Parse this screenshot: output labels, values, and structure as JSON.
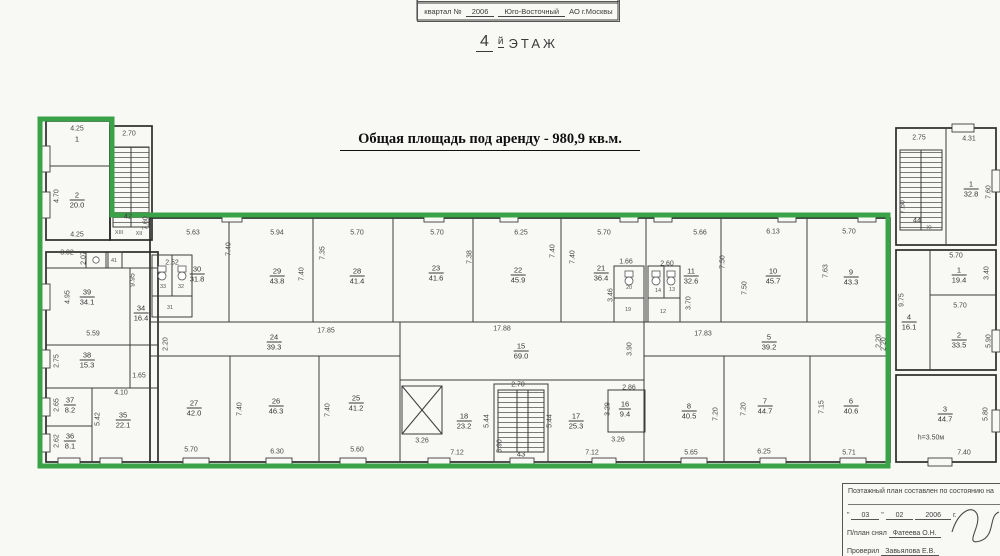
{
  "colors": {
    "outline_green": "#3aa348",
    "ink": "#3a3a3a",
    "paper": "#f8f8f5"
  },
  "header": {
    "box_label": "квартал №",
    "box_value": "2006",
    "box_region": "Юго-Восточный",
    "box_region2": "АО г.Москвы",
    "floor_number": "4",
    "floor_suffix": "й",
    "floor_word": "ЭТАЖ",
    "title": "Общая площадь под аренду - 980,9 кв.м."
  },
  "form": {
    "line1": "Поэтажный план составлен по состоянию на",
    "q1": "\"",
    "date_day": "03",
    "date_month": "02",
    "date_year": "2006",
    "year_suffix": "г.",
    "surveyor_label": "П/план снял",
    "surveyor_name": "Фатеева О.Н.",
    "checker_label": "Проверил",
    "checker_name": "Завьялова Е.В."
  },
  "plan": {
    "rooms": [
      {
        "num": "1",
        "area": "",
        "x": 77,
        "y": 139
      },
      {
        "num": "2",
        "area": "20.0",
        "x": 77,
        "y": 200
      },
      {
        "num": "39",
        "area": "34.1",
        "x": 87,
        "y": 297
      },
      {
        "num": "34",
        "area": "16.4",
        "x": 141,
        "y": 313
      },
      {
        "num": "38",
        "area": "15.3",
        "x": 87,
        "y": 360
      },
      {
        "num": "37",
        "area": "8.2",
        "x": 70,
        "y": 405
      },
      {
        "num": "36",
        "area": "8.1",
        "x": 70,
        "y": 441
      },
      {
        "num": "35",
        "area": "22.1",
        "x": 123,
        "y": 420
      },
      {
        "num": "30",
        "area": "31.8",
        "x": 197,
        "y": 274
      },
      {
        "num": "29",
        "area": "43.8",
        "x": 277,
        "y": 276
      },
      {
        "num": "28",
        "area": "41.4",
        "x": 357,
        "y": 276
      },
      {
        "num": "23",
        "area": "41.6",
        "x": 436,
        "y": 273
      },
      {
        "num": "22",
        "area": "45.9",
        "x": 518,
        "y": 275
      },
      {
        "num": "21",
        "area": "36.4",
        "x": 601,
        "y": 273
      },
      {
        "num": "11",
        "area": "32.6",
        "x": 691,
        "y": 276
      },
      {
        "num": "10",
        "area": "45.7",
        "x": 773,
        "y": 276
      },
      {
        "num": "9",
        "area": "43.3",
        "x": 851,
        "y": 277
      },
      {
        "num": "24",
        "area": "39.3",
        "x": 274,
        "y": 342
      },
      {
        "num": "15",
        "area": "69.0",
        "x": 521,
        "y": 351
      },
      {
        "num": "5",
        "area": "39.2",
        "x": 769,
        "y": 342
      },
      {
        "num": "27",
        "area": "42.0",
        "x": 194,
        "y": 408
      },
      {
        "num": "26",
        "area": "46.3",
        "x": 276,
        "y": 406
      },
      {
        "num": "25",
        "area": "41.2",
        "x": 356,
        "y": 403
      },
      {
        "num": "18",
        "area": "23.2",
        "x": 464,
        "y": 421
      },
      {
        "num": "17",
        "area": "25.3",
        "x": 576,
        "y": 421
      },
      {
        "num": "16",
        "area": "9.4",
        "x": 625,
        "y": 409
      },
      {
        "num": "8",
        "area": "40.5",
        "x": 689,
        "y": 411
      },
      {
        "num": "7",
        "area": "44.7",
        "x": 765,
        "y": 406
      },
      {
        "num": "6",
        "area": "40.6",
        "x": 851,
        "y": 406
      },
      {
        "num": "1",
        "area": "32.8",
        "x": 971,
        "y": 189
      },
      {
        "num": "1",
        "area": "19.4",
        "x": 959,
        "y": 275
      },
      {
        "num": "4",
        "area": "16.1",
        "x": 909,
        "y": 322
      },
      {
        "num": "2",
        "area": "33.5",
        "x": 959,
        "y": 340
      },
      {
        "num": "3",
        "area": "44.7",
        "x": 945,
        "y": 414
      }
    ],
    "stair_labels": [
      {
        "t": "42",
        "x": 128,
        "y": 216
      },
      {
        "t": "43",
        "x": 521,
        "y": 454
      },
      {
        "t": "44",
        "x": 917,
        "y": 220
      }
    ],
    "dims": [
      {
        "t": "4.25",
        "x": 77,
        "y": 129
      },
      {
        "t": "4.70",
        "x": 57,
        "y": 196,
        "r": 1
      },
      {
        "t": "4.25",
        "x": 77,
        "y": 235
      },
      {
        "t": "2.70",
        "x": 129,
        "y": 134
      },
      {
        "t": "7.60",
        "x": 146,
        "y": 223,
        "r": 1
      },
      {
        "t": "3.02",
        "x": 67,
        "y": 253
      },
      {
        "t": "2.07",
        "x": 84,
        "y": 258,
        "r": 1
      },
      {
        "t": "9.95",
        "x": 133,
        "y": 280,
        "r": 1
      },
      {
        "t": "4.95",
        "x": 68,
        "y": 297,
        "r": 1
      },
      {
        "t": "5.59",
        "x": 93,
        "y": 334
      },
      {
        "t": "2.75",
        "x": 57,
        "y": 361,
        "r": 1
      },
      {
        "t": "1.65",
        "x": 139,
        "y": 376
      },
      {
        "t": "4.10",
        "x": 121,
        "y": 393
      },
      {
        "t": "2.65",
        "x": 57,
        "y": 405,
        "r": 1
      },
      {
        "t": "2.62",
        "x": 57,
        "y": 441,
        "r": 1
      },
      {
        "t": "5.42",
        "x": 98,
        "y": 419,
        "r": 1
      },
      {
        "t": "5.63",
        "x": 193,
        "y": 233
      },
      {
        "t": "5.94",
        "x": 277,
        "y": 233
      },
      {
        "t": "5.70",
        "x": 357,
        "y": 233
      },
      {
        "t": "5.70",
        "x": 437,
        "y": 233
      },
      {
        "t": "6.25",
        "x": 521,
        "y": 233
      },
      {
        "t": "5.70",
        "x": 604,
        "y": 233
      },
      {
        "t": "5.66",
        "x": 700,
        "y": 233
      },
      {
        "t": "6.13",
        "x": 773,
        "y": 232
      },
      {
        "t": "5.70",
        "x": 849,
        "y": 232
      },
      {
        "t": "7.40",
        "x": 229,
        "y": 249,
        "r": 1
      },
      {
        "t": "7.40",
        "x": 302,
        "y": 274,
        "r": 1
      },
      {
        "t": "7.35",
        "x": 323,
        "y": 253,
        "r": 1
      },
      {
        "t": "7.38",
        "x": 470,
        "y": 257,
        "r": 1
      },
      {
        "t": "7.40",
        "x": 553,
        "y": 251,
        "r": 1
      },
      {
        "t": "7.40",
        "x": 573,
        "y": 257,
        "r": 1
      },
      {
        "t": "7.50",
        "x": 723,
        "y": 262,
        "r": 1
      },
      {
        "t": "7.50",
        "x": 745,
        "y": 288,
        "r": 1
      },
      {
        "t": "7.63",
        "x": 826,
        "y": 271,
        "r": 1
      },
      {
        "t": "2.52",
        "x": 172,
        "y": 263
      },
      {
        "t": "1.66",
        "x": 626,
        "y": 262
      },
      {
        "t": "2.60",
        "x": 667,
        "y": 264
      },
      {
        "t": "3.46",
        "x": 611,
        "y": 295,
        "r": 1
      },
      {
        "t": "3.70",
        "x": 689,
        "y": 303,
        "r": 1
      },
      {
        "t": "17.85",
        "x": 326,
        "y": 331
      },
      {
        "t": "2.20",
        "x": 166,
        "y": 344,
        "r": 1
      },
      {
        "t": "17.88",
        "x": 502,
        "y": 329
      },
      {
        "t": "3.90",
        "x": 630,
        "y": 349,
        "r": 1
      },
      {
        "t": "17.83",
        "x": 703,
        "y": 334
      },
      {
        "t": "2.20",
        "x": 884,
        "y": 344,
        "r": 1
      },
      {
        "t": "7.40",
        "x": 240,
        "y": 409,
        "r": 1
      },
      {
        "t": "7.40",
        "x": 328,
        "y": 410,
        "r": 1
      },
      {
        "t": "5.70",
        "x": 191,
        "y": 450
      },
      {
        "t": "6.30",
        "x": 277,
        "y": 452
      },
      {
        "t": "5.60",
        "x": 357,
        "y": 450
      },
      {
        "t": "3.26",
        "x": 422,
        "y": 441
      },
      {
        "t": "5.44",
        "x": 487,
        "y": 421,
        "r": 1
      },
      {
        "t": "2.70",
        "x": 518,
        "y": 385
      },
      {
        "t": "5.90",
        "x": 500,
        "y": 446,
        "r": 1
      },
      {
        "t": "5.44",
        "x": 550,
        "y": 421,
        "r": 1
      },
      {
        "t": "7.12",
        "x": 457,
        "y": 453
      },
      {
        "t": "7.12",
        "x": 592,
        "y": 453
      },
      {
        "t": "3.29",
        "x": 608,
        "y": 409,
        "r": 1
      },
      {
        "t": "2.86",
        "x": 629,
        "y": 388
      },
      {
        "t": "3.26",
        "x": 618,
        "y": 440
      },
      {
        "t": "7.20",
        "x": 716,
        "y": 414,
        "r": 1
      },
      {
        "t": "7.20",
        "x": 744,
        "y": 409,
        "r": 1
      },
      {
        "t": "7.15",
        "x": 822,
        "y": 407,
        "r": 1
      },
      {
        "t": "5.65",
        "x": 691,
        "y": 453
      },
      {
        "t": "6.25",
        "x": 764,
        "y": 452
      },
      {
        "t": "5.71",
        "x": 849,
        "y": 453
      },
      {
        "t": "2.75",
        "x": 919,
        "y": 138
      },
      {
        "t": "4.31",
        "x": 969,
        "y": 139
      },
      {
        "t": "7.60",
        "x": 903,
        "y": 207,
        "r": 1
      },
      {
        "t": "7.60",
        "x": 989,
        "y": 192,
        "r": 1
      },
      {
        "t": "5.70",
        "x": 956,
        "y": 256
      },
      {
        "t": "3.40",
        "x": 987,
        "y": 273,
        "r": 1
      },
      {
        "t": "9.75",
        "x": 902,
        "y": 300,
        "r": 1
      },
      {
        "t": "5.70",
        "x": 960,
        "y": 306
      },
      {
        "t": "2.20",
        "x": 879,
        "y": 341,
        "r": 1
      },
      {
        "t": "5.90",
        "x": 989,
        "y": 341,
        "r": 1
      },
      {
        "t": "5.80",
        "x": 986,
        "y": 414,
        "r": 1
      },
      {
        "t": "7.40",
        "x": 964,
        "y": 453
      },
      {
        "t": "h=3.50м",
        "x": 931,
        "y": 438
      }
    ],
    "tiny_labels": [
      {
        "t": "XIII",
        "x": 119,
        "y": 233
      },
      {
        "t": "XII",
        "x": 139,
        "y": 234
      },
      {
        "t": "XI",
        "x": 929,
        "y": 228
      },
      {
        "t": "41",
        "x": 114,
        "y": 261
      },
      {
        "t": "33",
        "x": 163,
        "y": 287
      },
      {
        "t": "32",
        "x": 181,
        "y": 287
      },
      {
        "t": "31",
        "x": 170,
        "y": 308
      },
      {
        "t": "20",
        "x": 629,
        "y": 288
      },
      {
        "t": "19",
        "x": 628,
        "y": 310
      },
      {
        "t": "14",
        "x": 658,
        "y": 291
      },
      {
        "t": "13",
        "x": 672,
        "y": 290
      },
      {
        "t": "12",
        "x": 663,
        "y": 312
      }
    ]
  }
}
